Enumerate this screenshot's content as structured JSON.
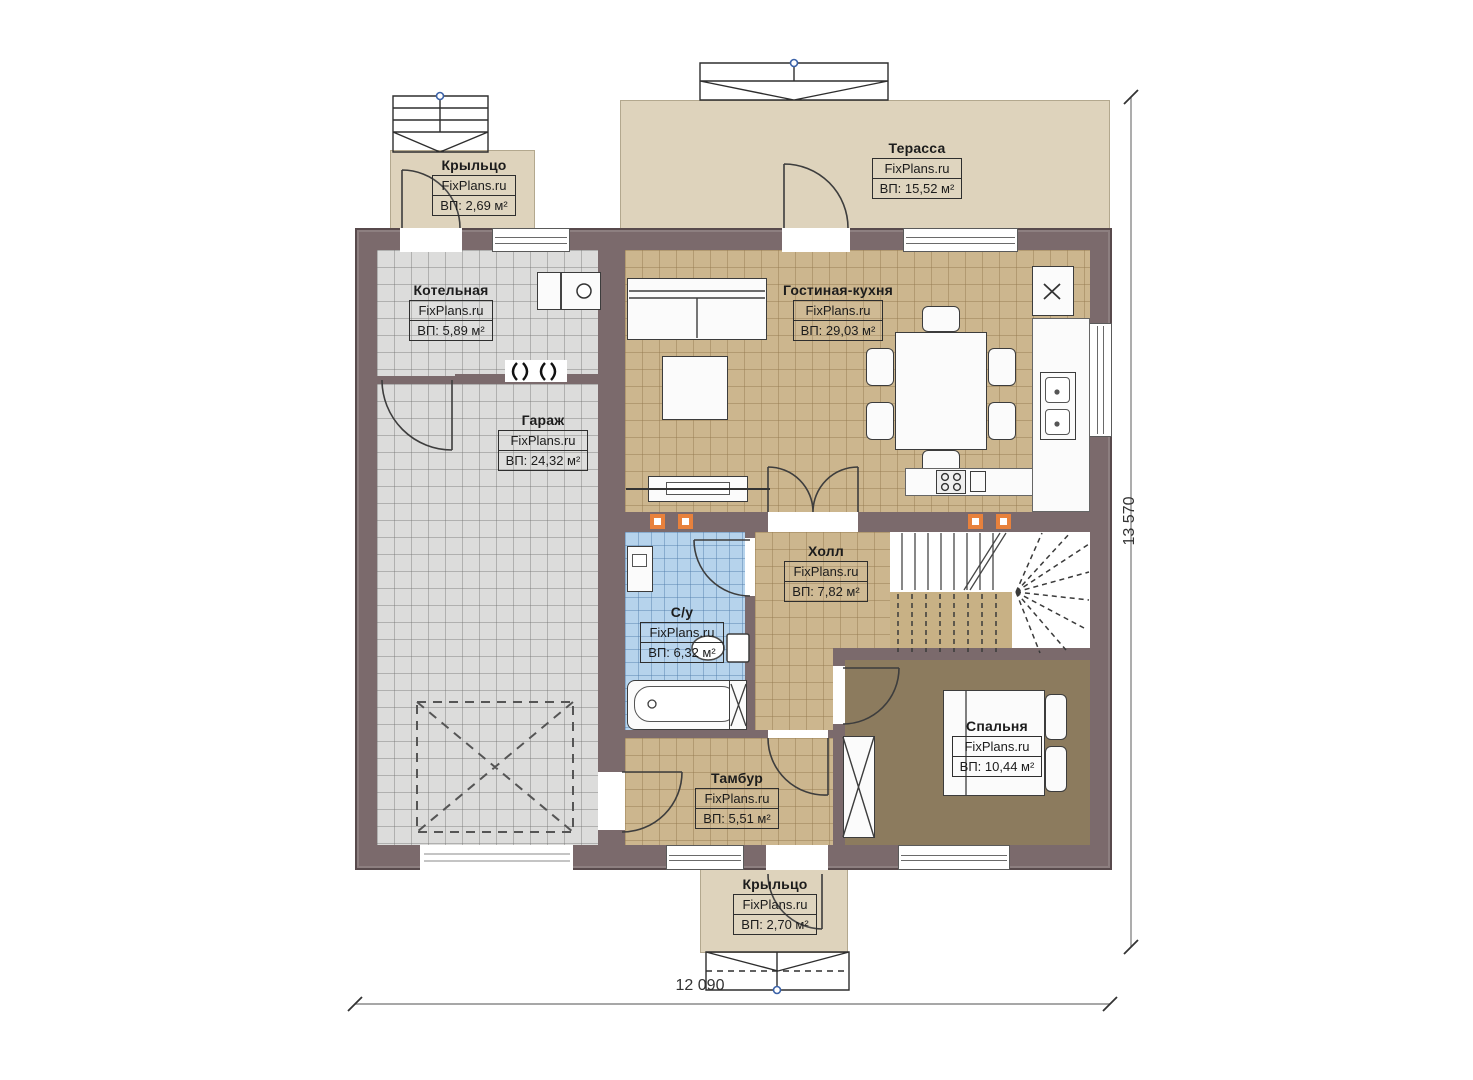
{
  "rooms": {
    "porch_top": {
      "title": "Крыльцо",
      "brand": "FixPlans.ru",
      "area": "ВП: 2,69 м²"
    },
    "terrace": {
      "title": "Терасса",
      "brand": "FixPlans.ru",
      "area": "ВП: 15,52 м²"
    },
    "boiler": {
      "title": "Котельная",
      "brand": "FixPlans.ru",
      "area": "ВП: 5,89 м²"
    },
    "garage": {
      "title": "Гараж",
      "brand": "FixPlans.ru",
      "area": "ВП: 24,32 м²"
    },
    "living_kitchen": {
      "title": "Гостиная-кухня",
      "brand": "FixPlans.ru",
      "area": "ВП: 29,03 м²"
    },
    "hall": {
      "title": "Холл",
      "brand": "FixPlans.ru",
      "area": "ВП: 7,82 м²"
    },
    "bathroom": {
      "title": "С/у",
      "brand": "FixPlans.ru",
      "area": "ВП: 6,32 м²"
    },
    "bedroom": {
      "title": "Спальня",
      "brand": "FixPlans.ru",
      "area": "ВП: 10,44 м²"
    },
    "vestibule": {
      "title": "Тамбур",
      "brand": "FixPlans.ru",
      "area": "ВП: 5,51 м²"
    },
    "porch_bottom": {
      "title": "Крыльцо",
      "brand": "FixPlans.ru",
      "area": "ВП: 2,70 м²"
    }
  },
  "dims": {
    "width": "12 090",
    "height": "13 570"
  },
  "colors": {
    "wall": "#7b6a6c",
    "floor_tan": "#ccb68e",
    "floor_gray": "#dcdcdb",
    "floor_blue": "#b6d3ec",
    "floor_wood": "#8c7b5e",
    "outdoor": "#ded3bc",
    "marker": "#e8813c"
  }
}
